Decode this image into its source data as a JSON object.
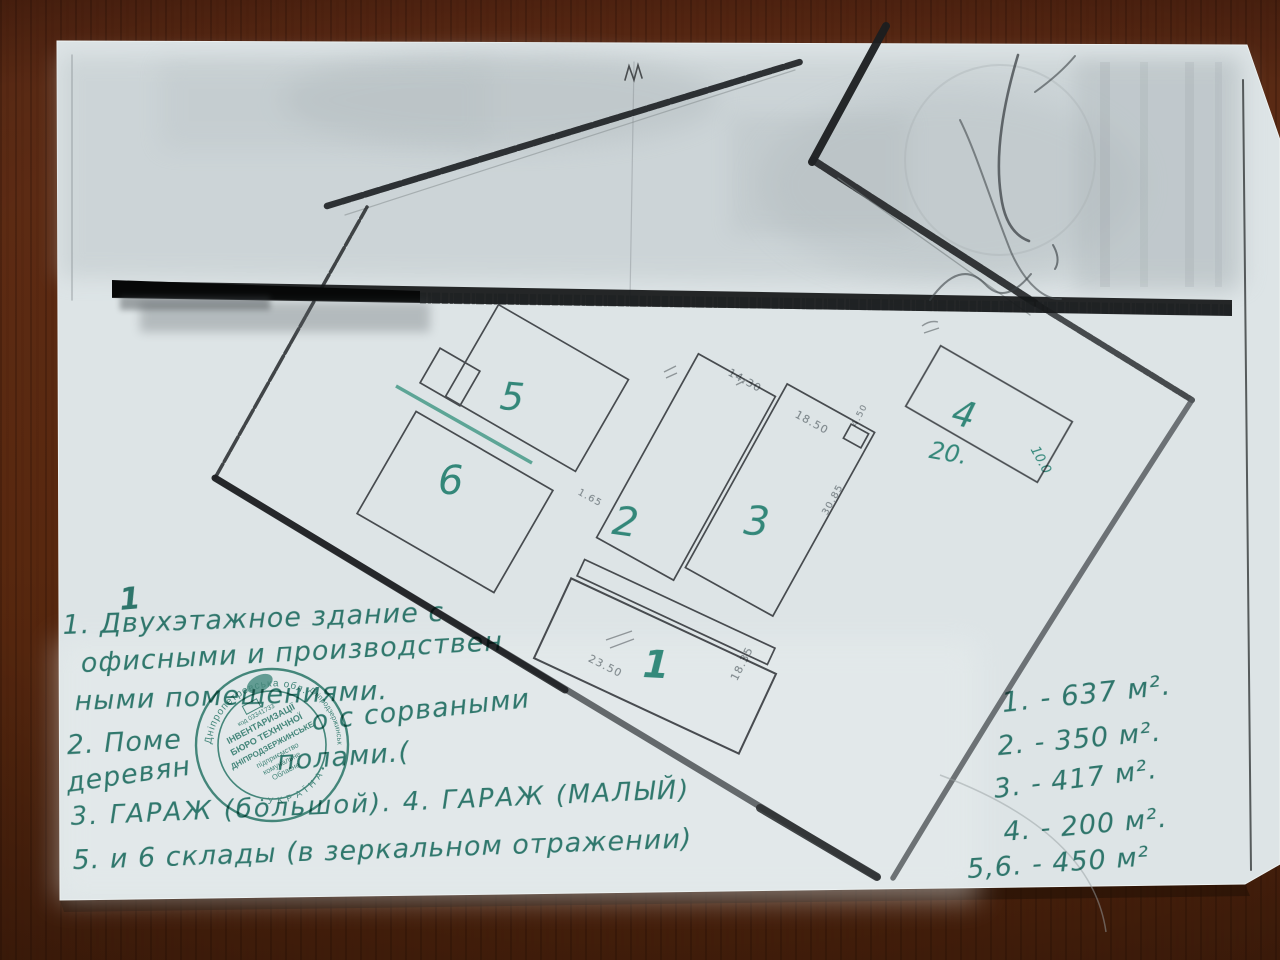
{
  "document_kind": "photographed photocopy of a land site plan with handwritten notes",
  "plan": {
    "building_labels": {
      "b1": "1",
      "b2": "2",
      "b3": "3",
      "b4": "4",
      "b5": "5",
      "b6": "6"
    },
    "green_dims": {
      "d20": "20.",
      "d10": "10.0"
    },
    "pencil_dims": {
      "d1": "14.30",
      "d2": "18.50",
      "d3": "4.50",
      "d4": "1.65",
      "d5": "30.85",
      "d6": "23.50",
      "d7": "18.35"
    }
  },
  "notes": {
    "mark": "1",
    "l1": "1. Двухэтажное здание с",
    "l2": "офисными и производствен",
    "l3": "ными помещениями.",
    "l4a": "2. Поме",
    "l4b": "о с сорваными",
    "l5a": "деревян",
    "l5b": "полами.(",
    "l6": "3. ГАРАЖ  (большой). 4. ГАРАЖ (МАЛЫЙ)",
    "l7": "5. и 6 склады (в зеркальном отражении)"
  },
  "areas": {
    "a1": "1. - 637 м².",
    "a2": "2. - 350 м².",
    "a3": "3. - 417 м².",
    "a4": "4. - 200 м².",
    "a56": "5,6. - 450 м²"
  },
  "stamp": {
    "ring_top": "Дніпропетровська обл.",
    "ring_right": "Дніпродзержинськ",
    "ring_bottom": "• У К Р А Ї Н А •",
    "inner1": "код 03341733",
    "inner2": "ІНВЕНТАРИЗАЦІЇ",
    "inner3": "БЮРО ТЕХНІЧНОЇ",
    "inner4": "ДНІПРОДЗЕРЖИНСЬКЕ",
    "inner5": "підприємство",
    "inner6": "комунальне",
    "inner7": "Обласне"
  },
  "colors": {
    "ink_green": "#23786a",
    "stamp_green": "#2d8070",
    "paper": "#dde4e6",
    "wood": "#58280f"
  }
}
